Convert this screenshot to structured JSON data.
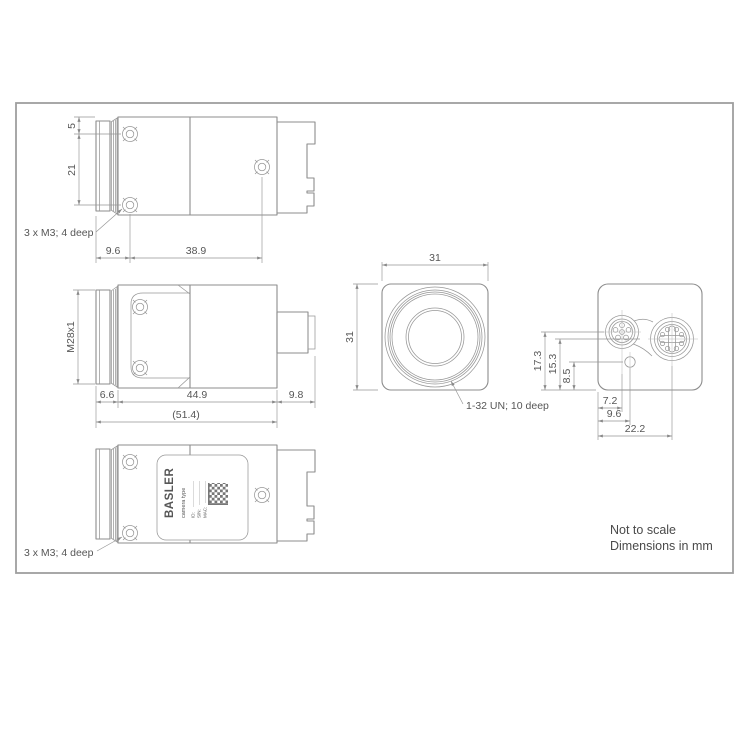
{
  "drawing": {
    "colors": {
      "line": "#8d8d8d",
      "dim_line": "#949494",
      "text": "#565656",
      "frame": "#9e9e9e",
      "background": "#ffffff"
    },
    "notes": {
      "not_to_scale": "Not to scale",
      "dimensions_in_mm": "Dimensions in mm"
    },
    "top_view": {
      "dim_flange": "5",
      "dim_screw_spacing": "21",
      "dim_front_offset": "9.6",
      "dim_screw_span": "38.9",
      "mount_label": "3 x M3; 4 deep"
    },
    "side_view": {
      "dim_thread": "M28x1",
      "dim_lens_ring": "6.6",
      "dim_body": "44.9",
      "dim_connector": "9.8",
      "dim_overall": "(51.4)"
    },
    "front_view": {
      "dim_width": "31",
      "dim_height": "31",
      "thread_label": "1-32 UN; 10 deep"
    },
    "back_view": {
      "dim_conn6_height": "17.3",
      "dim_conn8_height": "15.3",
      "dim_led_height": "8.5",
      "dim_conn6_x": "7.2",
      "dim_led_x": "9.6",
      "dim_conn8_x": "22.2"
    },
    "bottom_view": {
      "mount_label": "3 x M3; 4 deep",
      "sticker": {
        "brand": "BASLER",
        "type_line": "camera type",
        "field_id": "ID:",
        "field_sn": "S/N:",
        "field_mac": "MAC:"
      }
    }
  }
}
